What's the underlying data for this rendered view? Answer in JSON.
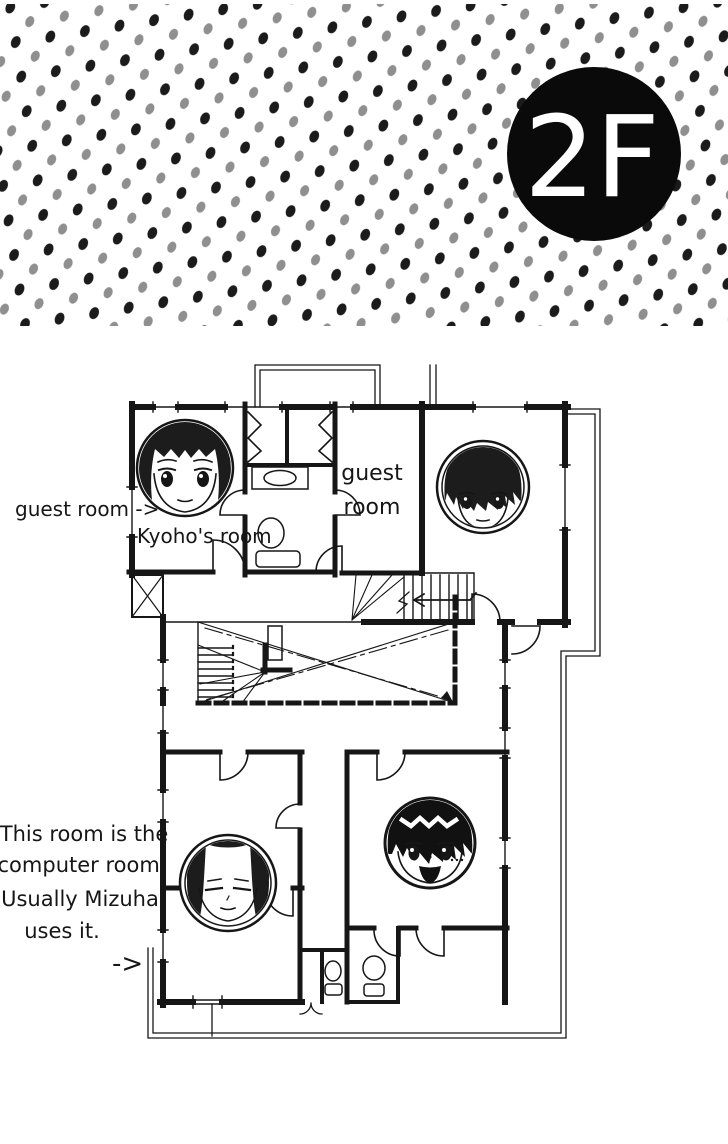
{
  "page": {
    "bg": "#ffffff",
    "ink": "#161616"
  },
  "header": {
    "halftone": {
      "dark_dot": "#1b1b1b",
      "gray_dot": "#8f8f8f"
    },
    "floor_badge": {
      "label": "2F",
      "bg": "#0a0a0a",
      "fg": "#ffffff"
    }
  },
  "floorplan": {
    "labels": {
      "left_arrow_label": "guest room ->",
      "kyoho_room": "Kyoho's room",
      "center_room_line1": "guest",
      "center_room_line2": "room",
      "note_line1": "This room is the",
      "note_line2": "computer room.",
      "note_line3": "Usually Mizuha",
      "note_line4": "uses it.",
      "note_arrow": "->"
    },
    "faces": [
      {
        "id": "long-haired-girl-face",
        "room": "kyoho-room"
      },
      {
        "id": "shaggy-haired-boy-face",
        "room": "upper-guest-room"
      },
      {
        "id": "center-parted-hair-face",
        "room": "computer-room"
      },
      {
        "id": "smiling-black-haired-boy-face",
        "room": "lower-right-bedroom"
      }
    ]
  }
}
